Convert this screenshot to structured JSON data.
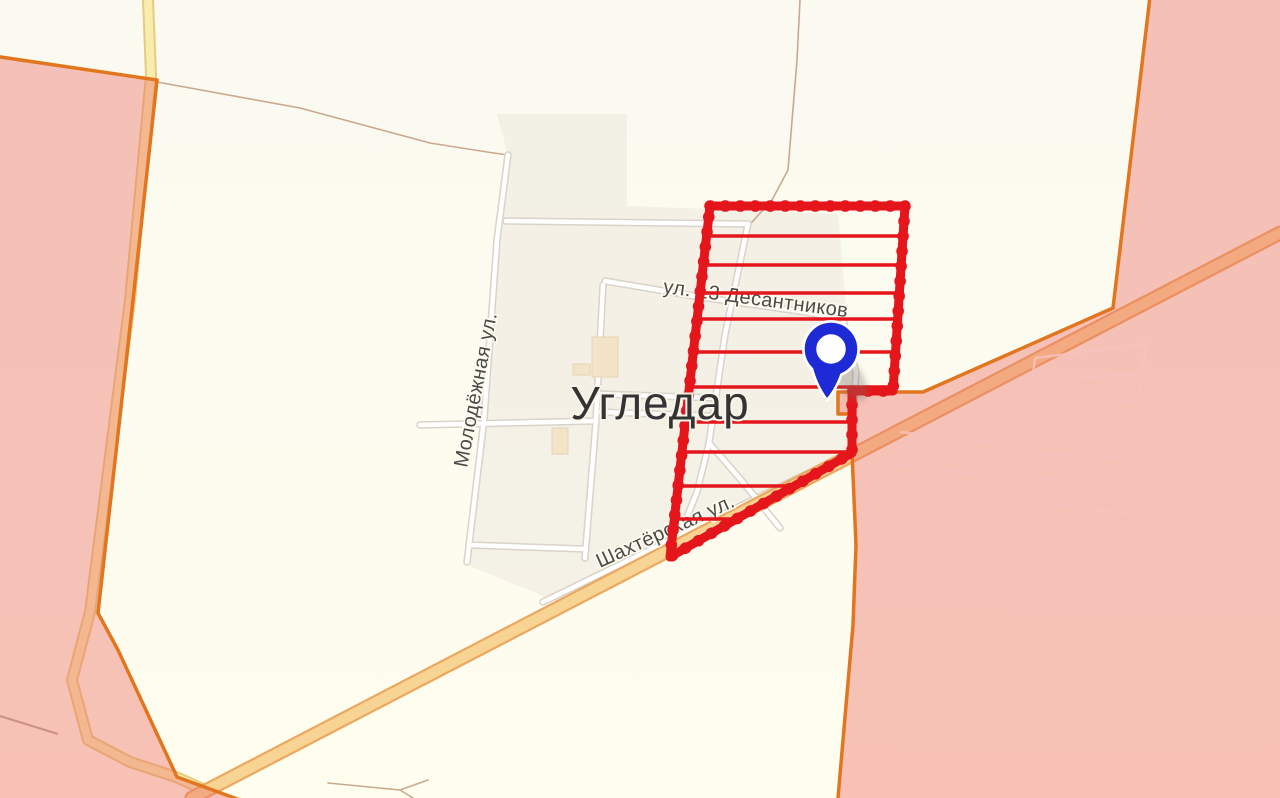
{
  "map": {
    "city_label": "Угледар",
    "streets": [
      {
        "id": "desantnikov",
        "label": "ул. 13 Десантников"
      },
      {
        "id": "molodezhnaya",
        "label": "Молодёжная ул."
      },
      {
        "id": "shakhtyorskaya",
        "label": "Шахтёрская ул."
      }
    ],
    "marker": {
      "name": "map-pin",
      "color": "#1d2ad6"
    },
    "colors": {
      "background": "#fdfcf2",
      "town_area": "#efeadf",
      "assault_zone_red": "#e5161b",
      "occupied_fill": "rgba(236,113,103,0.42)",
      "occupied_border": "#e2761f",
      "highway_fill": "#f8d494",
      "highway_casing": "#eda85f",
      "secondary_road_fill": "#f8edaf",
      "street_fill": "#ffffff",
      "pin_blue": "#1d2ad6"
    }
  }
}
